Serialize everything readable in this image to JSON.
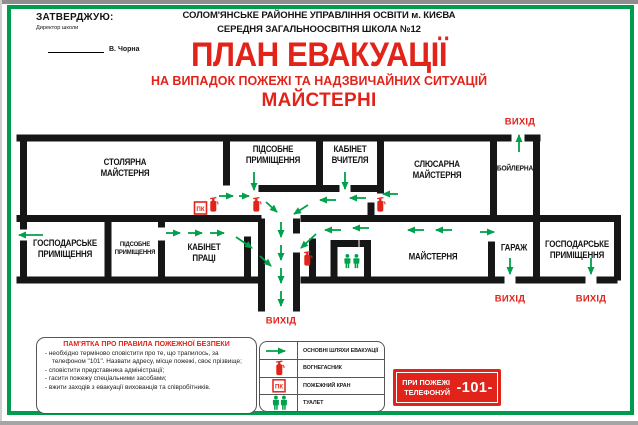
{
  "approve": {
    "title": "ЗАТВЕРДЖУЮ:",
    "role": "Директор школи",
    "signature": "В. Чорна"
  },
  "header": {
    "org1": "СОЛОМ'ЯНСЬКЕ РАЙОННЕ УПРАВЛІННЯ ОСВІТИ м. КИЄВА",
    "org2": "СЕРЕДНЯ ЗАГАЛЬНООСВІТНЯ ШКОЛА №12",
    "title": "ПЛАН ЕВАКУАЦІЇ",
    "subtitle": "НА ВИПАДОК ПОЖЕЖІ ТА НАДЗВИЧАЙНИХ СИТУАЦІЙ",
    "section": "МАЙСТЕРНІ"
  },
  "plan": {
    "rooms": {
      "stolyarna": "СТОЛЯРНА\nМАЙСТЕРНЯ",
      "pidsobne_top": "ПІДСОБНЕ\nПРИМІЩЕННЯ",
      "kabinet_vchytelya": "КАБІНЕТ\nВЧИТЕЛЯ",
      "slyusarna": "СЛЮСАРНА\nМАЙСТЕРНЯ",
      "boilerna": "БОЙЛЕРНА",
      "hospodarske_left": "ГОСПОДАРСЬКЕ\nПРИМІЩЕННЯ",
      "pidsobne_bottom": "ПІДСОБНЕ\nПРИМІЩЕННЯ",
      "kabinet_pratsi": "КАБІНЕТ\nПРАЦІ",
      "maisternya": "МАЙСТЕРНЯ",
      "harazh": "ГАРАЖ",
      "hospodarske_right": "ГОСПОДАРСЬКЕ\nПРИМІЩЕННЯ"
    },
    "exit_label": "ВИХІД",
    "pk_label": "ПК"
  },
  "memo": {
    "title": "ПАМ'ЯТКА ПРО ПРАВИЛА ПОЖЕЖНОЇ БЕЗПЕКИ",
    "items": [
      "- необхідно терміново сповістити про те, що трапилось, за телефоном \"101\". Назвати адресу, місце пожежі, своє прізвище;",
      "- сповістити представника адміністрації;",
      "- гасити пожежу спеціальними засобами;",
      "- вжити заходів з евакуації вихованців та співробітників."
    ]
  },
  "legend": {
    "items": [
      {
        "label": "ОСНОВНІ ШЛЯХИ ЕВАКУАЦІЇ"
      },
      {
        "label": "ВОГНЕГАСНИК"
      },
      {
        "label": "ПОЖЕЖНИЙ КРАН"
      },
      {
        "label": "ТУАЛЕТ"
      }
    ]
  },
  "phone": {
    "line1": "ПРИ ПОЖЕЖІ",
    "line2": "ТЕЛЕФОНУЙ",
    "number": "-101-"
  },
  "colors": {
    "accent_red": "#E2231A",
    "evacuation_green": "#00A14B",
    "wall_black": "#161616",
    "frame_green": "#009C4D"
  }
}
